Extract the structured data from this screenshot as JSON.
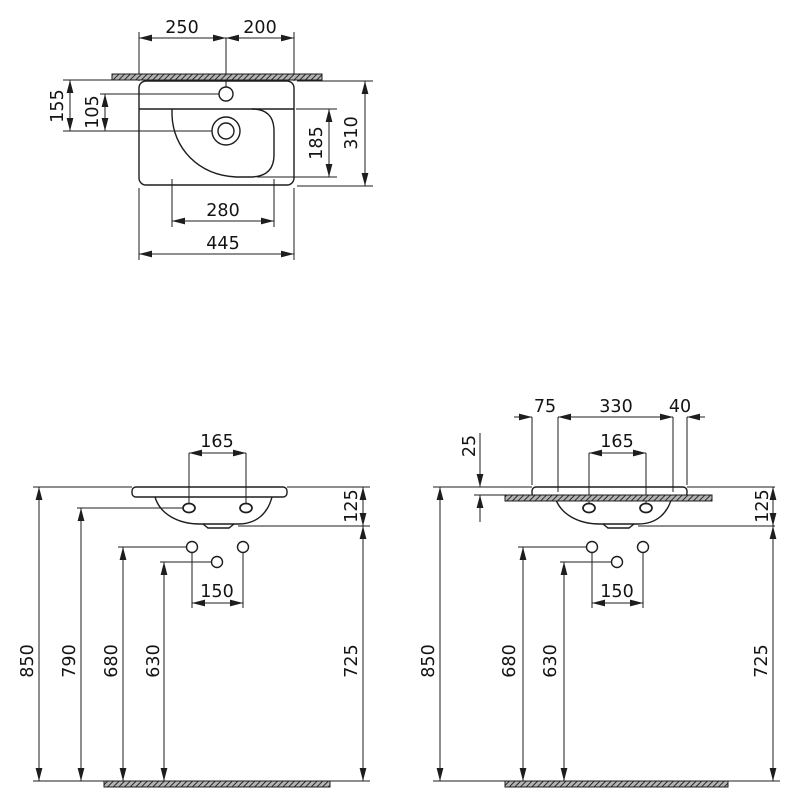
{
  "page": {
    "width": 800,
    "height": 800,
    "background": "#ffffff"
  },
  "style": {
    "line_color": "#1d1d1d",
    "text_color": "#141414",
    "hatch_base": "#b4b4b4",
    "hatch_stripe": "#2a2a2a",
    "font_size": 17.5,
    "arrow_length": 13,
    "arrow_half_width": 3.4
  },
  "views": [
    {
      "id": "plan-view",
      "kind": "washbasin-top-view",
      "hatch_bars": [
        [
          112,
          74,
          210,
          6
        ]
      ],
      "outline_rects": [
        [
          139,
          81,
          155,
          104,
          7
        ]
      ],
      "paths": [
        "M139,109 L294,109",
        "M252,109 Q274,109 274,131 L274,155 Q274,177 250,177 L236,177 C198,175 173,148 172,115 L172,109"
      ],
      "circles": [
        [
          226,
          94,
          7
        ],
        [
          226,
          131,
          14
        ],
        [
          226,
          131,
          8
        ]
      ],
      "ellipses": [],
      "lines": [
        [
          63,
          80,
          112,
          80
        ],
        [
          100,
          94,
          219,
          94
        ],
        [
          63,
          131,
          212,
          131
        ],
        [
          139,
          32,
          139,
          81
        ],
        [
          226,
          38,
          226,
          87
        ],
        [
          294,
          32,
          294,
          81
        ],
        [
          297,
          81,
          373,
          81
        ],
        [
          296,
          109,
          337,
          109
        ],
        [
          257,
          177,
          337,
          177
        ],
        [
          297,
          186,
          373,
          186
        ],
        [
          172,
          179,
          172,
          227
        ],
        [
          274,
          179,
          274,
          227
        ],
        [
          139,
          188,
          139,
          260
        ],
        [
          294,
          188,
          294,
          260
        ]
      ],
      "dims": [
        [
          139,
          38,
          226,
          38,
          1,
          1
        ],
        [
          226,
          38,
          294,
          38,
          1,
          1
        ],
        [
          70,
          80,
          70,
          131,
          1,
          1
        ],
        [
          105,
          94,
          105,
          131,
          1,
          1
        ],
        [
          329,
          109,
          329,
          177,
          1,
          1
        ],
        [
          365,
          81,
          365,
          186,
          1,
          1
        ],
        [
          172,
          221,
          274,
          221,
          1,
          1
        ],
        [
          139,
          254,
          294,
          254,
          1,
          1
        ]
      ],
      "labels": [
        {
          "value": "250",
          "x": 182,
          "y": 28,
          "rot": 0
        },
        {
          "value": "200",
          "x": 260,
          "y": 28,
          "rot": 0
        },
        {
          "value": "155",
          "x": 58,
          "y": 106,
          "rot": -90
        },
        {
          "value": "105",
          "x": 93,
          "y": 112,
          "rot": -90
        },
        {
          "value": "185",
          "x": 317,
          "y": 143,
          "rot": -90
        },
        {
          "value": "310",
          "x": 352,
          "y": 133,
          "rot": -90
        },
        {
          "value": "280",
          "x": 223,
          "y": 211,
          "rot": 0
        },
        {
          "value": "445",
          "x": 223,
          "y": 244,
          "rot": 0
        }
      ]
    },
    {
      "id": "front-view",
      "kind": "washbasin-front-view",
      "hatch_bars": [
        [
          104,
          781,
          226,
          6
        ]
      ],
      "outline_rects": [
        [
          132,
          487,
          155,
          10,
          4
        ]
      ],
      "paths": [
        "M155,497 C160,514 178,524 200,524 L238,524 C258,524 268,512 272,497",
        "M203,524 L208,528 L229,528 L234,524"
      ],
      "circles": [
        [
          192,
          547,
          5.5
        ],
        [
          243,
          547,
          5.5
        ],
        [
          217,
          562,
          5.5
        ]
      ],
      "ellipses": [
        [
          189,
          508,
          6,
          4.5
        ],
        [
          246,
          508,
          6,
          4.5
        ]
      ],
      "lines": [
        [
          33,
          487,
          132,
          487
        ],
        [
          287,
          487,
          370,
          487
        ],
        [
          238,
          526,
          370,
          526
        ],
        [
          77,
          508,
          182,
          508
        ],
        [
          118,
          547,
          186,
          547
        ],
        [
          160,
          562,
          211,
          562
        ],
        [
          189,
          453,
          189,
          503
        ],
        [
          246,
          453,
          246,
          503
        ],
        [
          192,
          553,
          192,
          608
        ],
        [
          243,
          553,
          243,
          608
        ],
        [
          33,
          781,
          370,
          781
        ]
      ],
      "dims": [
        [
          189,
          453,
          246,
          453,
          1,
          1
        ],
        [
          363,
          487,
          363,
          526,
          1,
          1
        ],
        [
          39,
          487,
          39,
          781,
          1,
          1
        ],
        [
          81,
          508,
          81,
          781,
          1,
          1
        ],
        [
          123,
          547,
          123,
          781,
          1,
          1
        ],
        [
          164,
          562,
          164,
          781,
          1,
          1
        ],
        [
          192,
          603,
          243,
          603,
          1,
          1
        ],
        [
          363,
          526,
          363,
          781,
          1,
          1
        ]
      ],
      "labels": [
        {
          "value": "165",
          "x": 217,
          "y": 442,
          "rot": 0
        },
        {
          "value": "125",
          "x": 352,
          "y": 506,
          "rot": -90
        },
        {
          "value": "850",
          "x": 28,
          "y": 661,
          "rot": -90
        },
        {
          "value": "790",
          "x": 70,
          "y": 661,
          "rot": -90
        },
        {
          "value": "680",
          "x": 112,
          "y": 661,
          "rot": -90
        },
        {
          "value": "630",
          "x": 154,
          "y": 661,
          "rot": -90
        },
        {
          "value": "150",
          "x": 217,
          "y": 592,
          "rot": 0
        },
        {
          "value": "725",
          "x": 352,
          "y": 661,
          "rot": -90
        }
      ]
    },
    {
      "id": "front-view-wall-mounted",
      "kind": "washbasin-front-view-with-wall",
      "hatch_bars": [
        [
          505,
          495,
          207,
          6
        ],
        [
          505,
          781,
          223,
          6
        ]
      ],
      "outline_rects": [
        [
          532,
          487,
          155,
          10,
          4
        ]
      ],
      "paths": [
        "M555,497 C560,514 578,524 600,524 L638,524 C658,524 668,512 672,497",
        "M603,524 L608,528 L629,528 L634,524"
      ],
      "circles": [
        [
          592,
          547,
          5.5
        ],
        [
          643,
          547,
          5.5
        ],
        [
          617,
          562,
          5.5
        ]
      ],
      "ellipses": [
        [
          589,
          508,
          6,
          4.5
        ],
        [
          646,
          508,
          6,
          4.5
        ]
      ],
      "lines": [
        [
          433,
          487,
          532,
          487
        ],
        [
          474,
          495,
          505,
          495
        ],
        [
          687,
          487,
          775,
          487
        ],
        [
          638,
          526,
          775,
          526
        ],
        [
          518,
          547,
          586,
          547
        ],
        [
          560,
          562,
          611,
          562
        ],
        [
          532,
          417,
          532,
          485
        ],
        [
          558,
          417,
          558,
          492
        ],
        [
          673,
          417,
          673,
          492
        ],
        [
          687,
          417,
          687,
          485
        ],
        [
          589,
          453,
          589,
          503
        ],
        [
          646,
          453,
          646,
          503
        ],
        [
          592,
          553,
          592,
          608
        ],
        [
          643,
          553,
          643,
          608
        ],
        [
          433,
          781,
          780,
          781
        ]
      ],
      "dims": [
        [
          514,
          417,
          532,
          417,
          0,
          1
        ],
        [
          558,
          417,
          673,
          417,
          1,
          1
        ],
        [
          687,
          417,
          705,
          417,
          1,
          0
        ],
        [
          480,
          433,
          480,
          487,
          0,
          1
        ],
        [
          480,
          522,
          480,
          495,
          0,
          1
        ],
        [
          589,
          453,
          646,
          453,
          1,
          1
        ],
        [
          773,
          487,
          773,
          526,
          1,
          1
        ],
        [
          440,
          487,
          440,
          781,
          1,
          1
        ],
        [
          523,
          547,
          523,
          781,
          1,
          1
        ],
        [
          564,
          562,
          564,
          781,
          1,
          1
        ],
        [
          592,
          603,
          643,
          603,
          1,
          1
        ],
        [
          773,
          526,
          773,
          781,
          1,
          1
        ]
      ],
      "labels": [
        {
          "value": "75",
          "x": 545,
          "y": 407,
          "rot": 0
        },
        {
          "value": "330",
          "x": 616,
          "y": 407,
          "rot": 0
        },
        {
          "value": "40",
          "x": 680,
          "y": 407,
          "rot": 0
        },
        {
          "value": "25",
          "x": 470,
          "y": 446,
          "rot": -90
        },
        {
          "value": "165",
          "x": 617,
          "y": 442,
          "rot": 0
        },
        {
          "value": "125",
          "x": 763,
          "y": 506,
          "rot": -90
        },
        {
          "value": "850",
          "x": 429,
          "y": 661,
          "rot": -90
        },
        {
          "value": "680",
          "x": 510,
          "y": 661,
          "rot": -90
        },
        {
          "value": "630",
          "x": 551,
          "y": 661,
          "rot": -90
        },
        {
          "value": "150",
          "x": 617,
          "y": 592,
          "rot": 0
        },
        {
          "value": "725",
          "x": 762,
          "y": 661,
          "rot": -90
        }
      ]
    }
  ]
}
